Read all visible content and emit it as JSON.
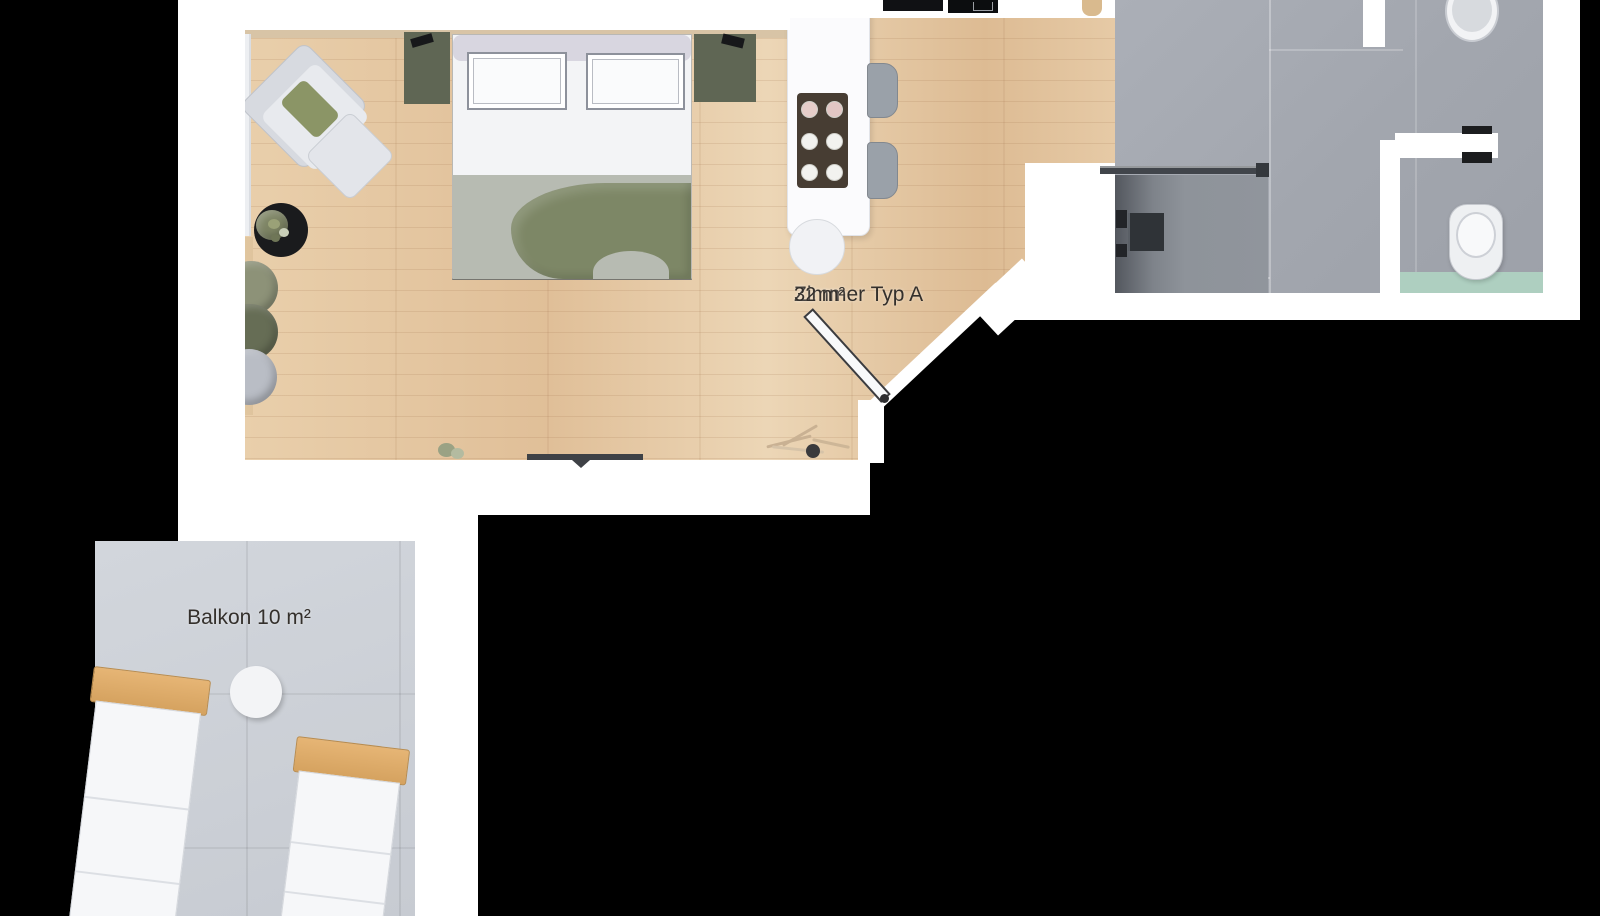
{
  "floorplan": {
    "unit_label": {
      "line1": "Zimmer Typ A",
      "line2": "32 m²"
    },
    "balcony_label": "Balkon 10 m²",
    "rooms": [
      {
        "name": "Zimmer Typ A",
        "area_m2": 32
      },
      {
        "name": "Balkon",
        "area_m2": 10
      }
    ],
    "colors": {
      "background": "#000000",
      "wall": "#ffffff",
      "wood_floor": "#e3c5a3",
      "tile_floor": "#a4a8b0",
      "shower_floor": "#7e838a",
      "balcony_floor": "#ccd0d7",
      "blanket_green": "#7d8766",
      "panel_olive": "#5f6654",
      "mat_green": "#aecfc0",
      "lounger_wood": "#d5a25f",
      "label_text": "#34302c"
    }
  }
}
